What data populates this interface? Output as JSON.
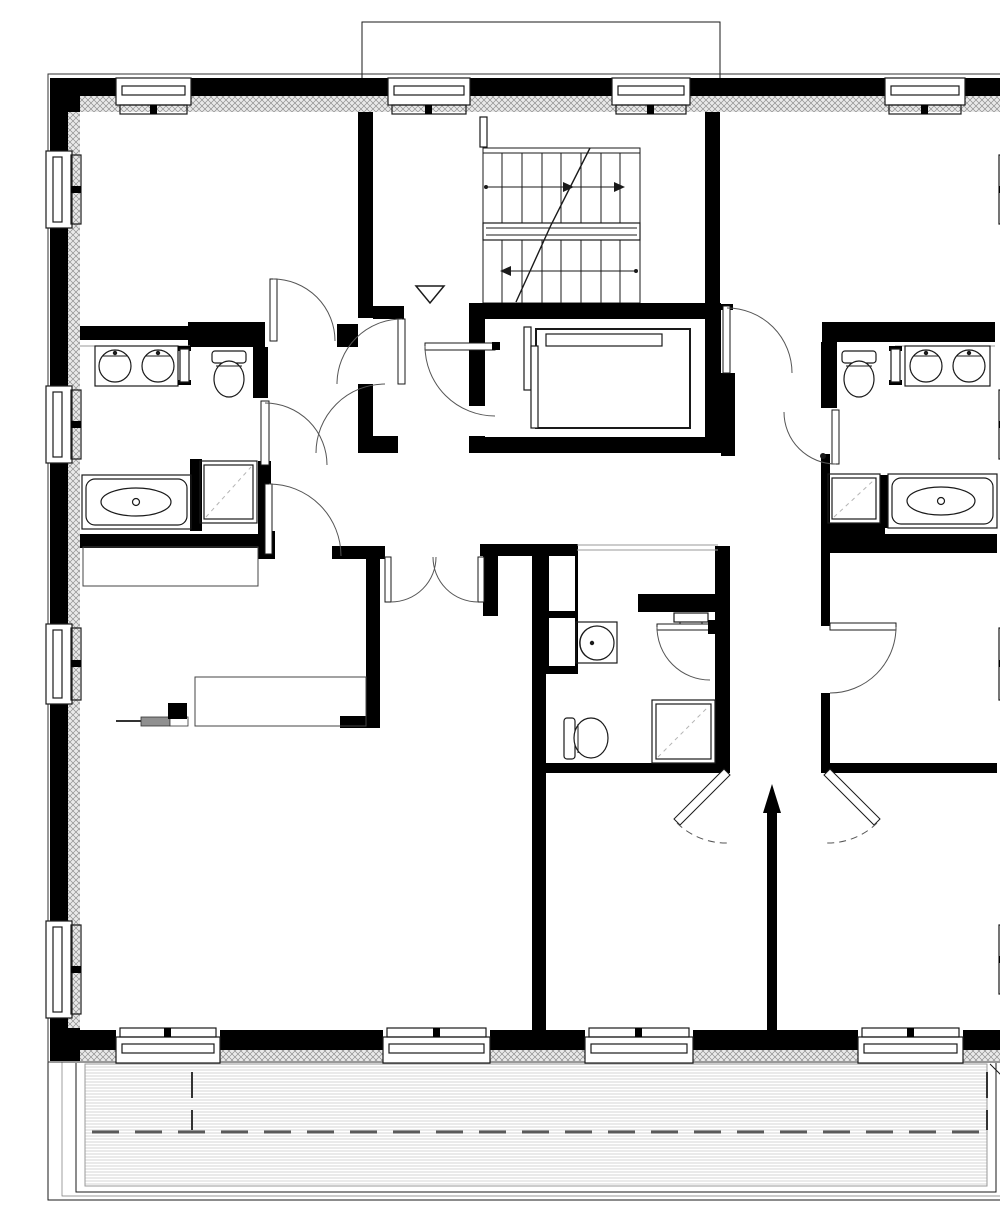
{
  "meta": {
    "title": "Residential floor plan — two apartments around a central stair and elevator core with south balcony",
    "drawing_type": "architectural floor plan, black and white CAD linework",
    "scale_note": "no text, dimensions or labels are printed on the drawing"
  },
  "colors": {
    "wall": "#000000",
    "bg": "#ffffff",
    "hatch": "#8f8f8f",
    "hatchbg": "#e9e9e9",
    "thin": "#1a1a1a",
    "mid": "#555555",
    "deck": "#c9c9c9",
    "dash": "#5a5a5a",
    "soft": "#9a9a9a"
  },
  "plan": {
    "core": [
      "staircase-two-flights-with-landing",
      "elevator-shaft-with-car",
      "entry-vestibule-with-direction-triangle"
    ],
    "rooms": [
      {
        "name": "bedroom-top-left"
      },
      {
        "name": "bathroom-left",
        "fixtures": [
          "double-sink-vanity",
          "toilet",
          "bathtub",
          "shower"
        ]
      },
      {
        "name": "living-room-bottom-left",
        "fixtures": [
          "wardrobe",
          "desk",
          "section-marker"
        ]
      },
      {
        "name": "central-wc",
        "fixtures": [
          "wash-basin",
          "toilet",
          "shower",
          "radiator",
          "duct-shaft"
        ]
      },
      {
        "name": "bedroom-top-right"
      },
      {
        "name": "bathroom-right",
        "fixtures": [
          "toilet",
          "double-sink-vanity",
          "shower",
          "bathtub"
        ]
      },
      {
        "name": "room-mid-right"
      },
      {
        "name": "room-bottom-center"
      },
      {
        "name": "room-bottom-right"
      },
      {
        "name": "balcony-south",
        "features": [
          "plank-decking",
          "dashed-center-line",
          "edge-steps"
        ]
      }
    ],
    "counts": {
      "windows_top": 4,
      "windows_bottom": 4,
      "windows_left": 4,
      "windows_right": 4,
      "door_swings": 12,
      "double_door_sets": 2,
      "sink_basins": 5,
      "toilets": 3,
      "bathtubs": 2,
      "showers": 3,
      "stair_flights": 2,
      "elevators": 1
    }
  }
}
